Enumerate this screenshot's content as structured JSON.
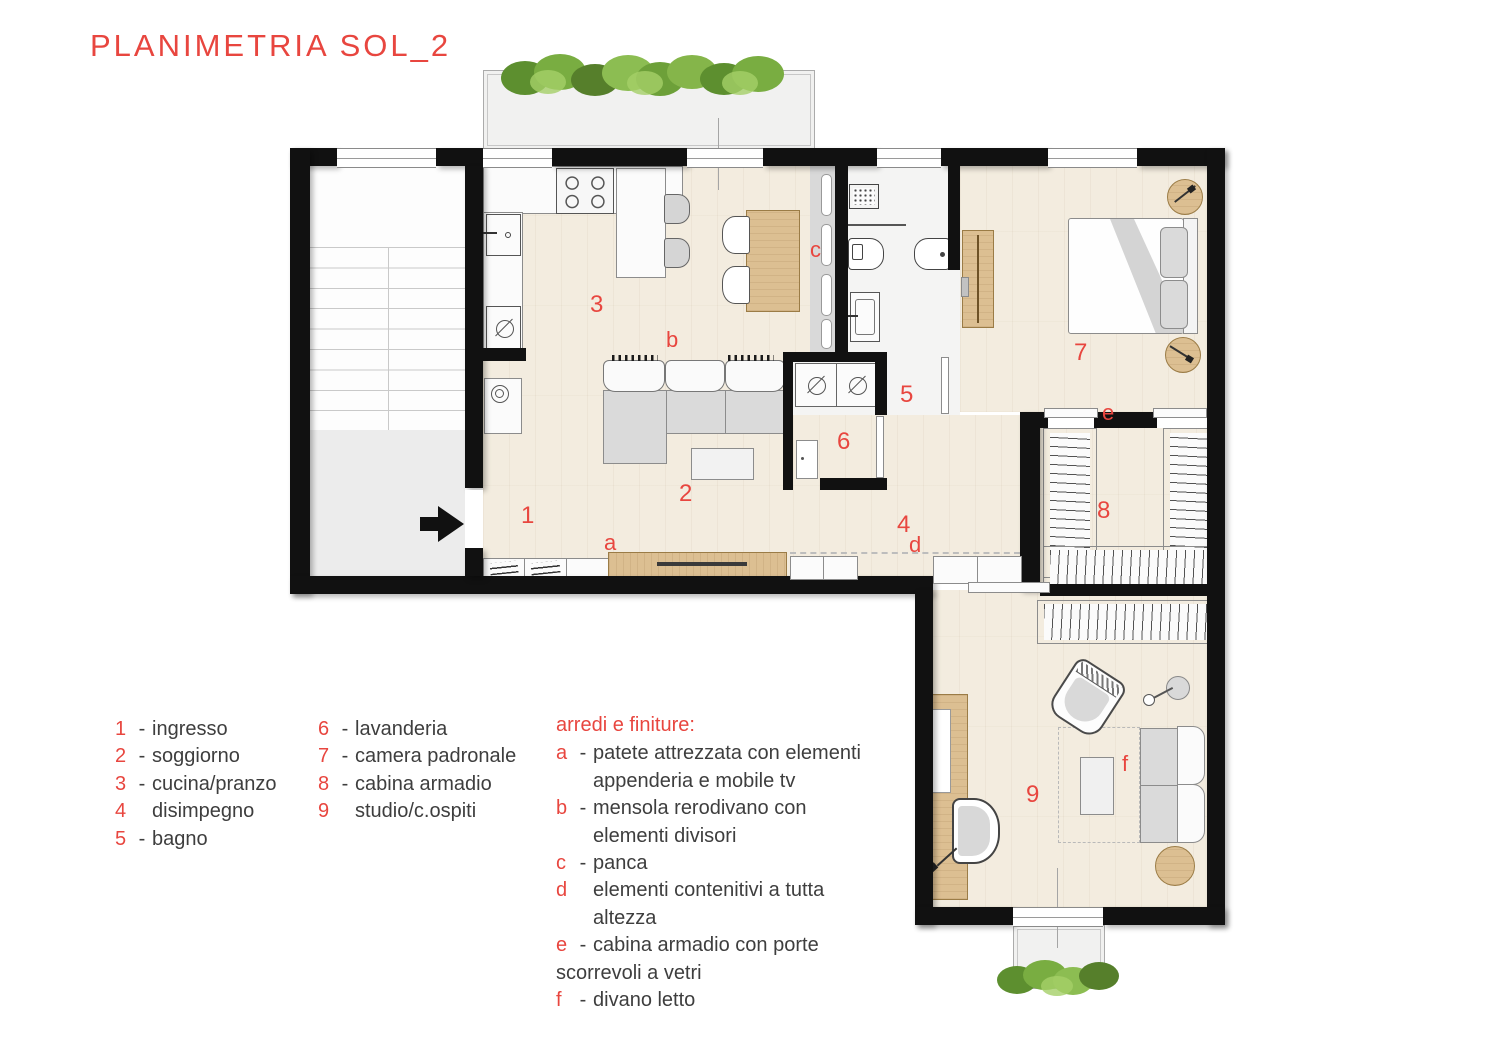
{
  "title": "PLANIMETRIA SOL_2",
  "colors": {
    "accent_red": "#e8463f",
    "wall_black": "#111111",
    "wood_furniture": "#dcbf92",
    "wood_floor": "#f3ecdf",
    "hedge_green": "#76a33c"
  },
  "plan": {
    "room_labels": {
      "r1": "1",
      "r2": "2",
      "r3": "3",
      "r4": "4",
      "r5": "5",
      "r6": "6",
      "r7": "7",
      "r8": "8",
      "r9": "9"
    },
    "feature_labels": {
      "a": "a",
      "b": "b",
      "c": "c",
      "d": "d",
      "e": "e",
      "f": "f"
    }
  },
  "legend": {
    "rooms": [
      {
        "num": "1",
        "sep": "-",
        "label": "ingresso"
      },
      {
        "num": "2",
        "sep": "-",
        "label": "soggiorno"
      },
      {
        "num": "3",
        "sep": "-",
        "label": "cucina/pranzo"
      },
      {
        "num": "4",
        "sep": "",
        "label": "disimpegno"
      },
      {
        "num": "5",
        "sep": "-",
        "label": "bagno"
      },
      {
        "num": "6",
        "sep": "-",
        "label": "lavanderia"
      },
      {
        "num": "7",
        "sep": "-",
        "label": "camera padronale"
      },
      {
        "num": "8",
        "sep": "-",
        "label": "cabina armadio"
      },
      {
        "num": "9",
        "sep": "",
        "label": "studio/c.ospiti"
      }
    ],
    "furnishings_title": "arredi e finiture:",
    "furnishings": [
      {
        "key": "a",
        "sep": "-",
        "line1": "patete attrezzata con elementi",
        "line2": "appenderia e mobile tv"
      },
      {
        "key": "b",
        "sep": "-",
        "line1": "mensola rerodivano con",
        "line2": "elementi divisori"
      },
      {
        "key": "c",
        "sep": "-",
        "line1": "panca",
        "line2": ""
      },
      {
        "key": "d",
        "sep": "",
        "line1": "elementi contenitivi a tutta",
        "line2": "altezza"
      },
      {
        "key": "e",
        "sep": "-",
        "line1": "cabina armadio con porte",
        "line2": "scorrevoli a vetri"
      },
      {
        "key": "f",
        "sep": "-",
        "line1": "divano letto",
        "line2": ""
      }
    ]
  }
}
